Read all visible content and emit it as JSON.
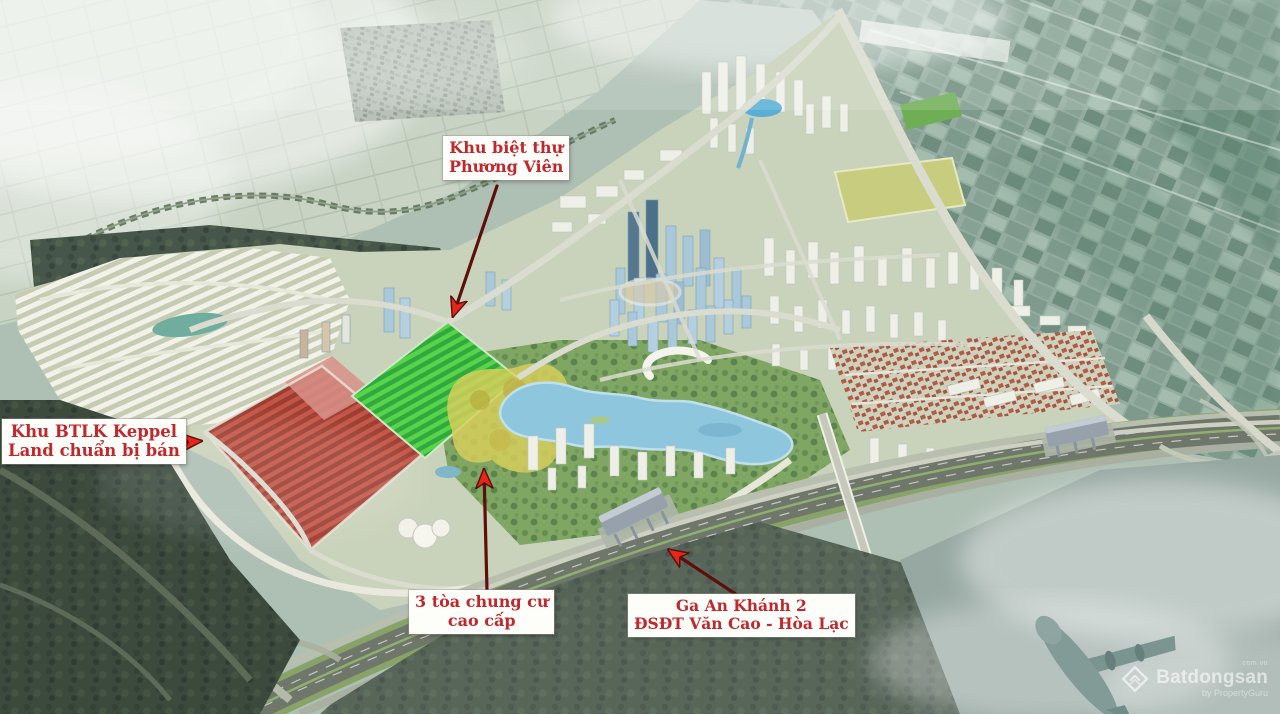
{
  "annotations": {
    "phuong_vien": {
      "line1": "Khu biệt thự",
      "line2": "Phương Viên"
    },
    "keppel": {
      "line1": "Khu BTLK Keppel",
      "line2": "Land chuẩn bị bán"
    },
    "chung_cu": {
      "line1": "3 tòa chung cư",
      "line2": "cao cấp"
    },
    "ga_an_khanh": {
      "line1": "Ga An Khánh 2",
      "line2": "ĐSĐT Văn Cao - Hòa Lạc"
    }
  },
  "watermark": {
    "brand": "Batdongsan",
    "domain": ".com.vn",
    "byline": "by PropertyGuru"
  },
  "colors": {
    "annotation_text": "#c1272d",
    "arrow_shaft": "#5c0f0b",
    "arrow_head": "#e52619",
    "highlight_red": "#c05a4a",
    "highlight_green": "#55d44c",
    "highlight_yellow": "#d9cf5c",
    "lake_blue": "#8ec6de"
  }
}
